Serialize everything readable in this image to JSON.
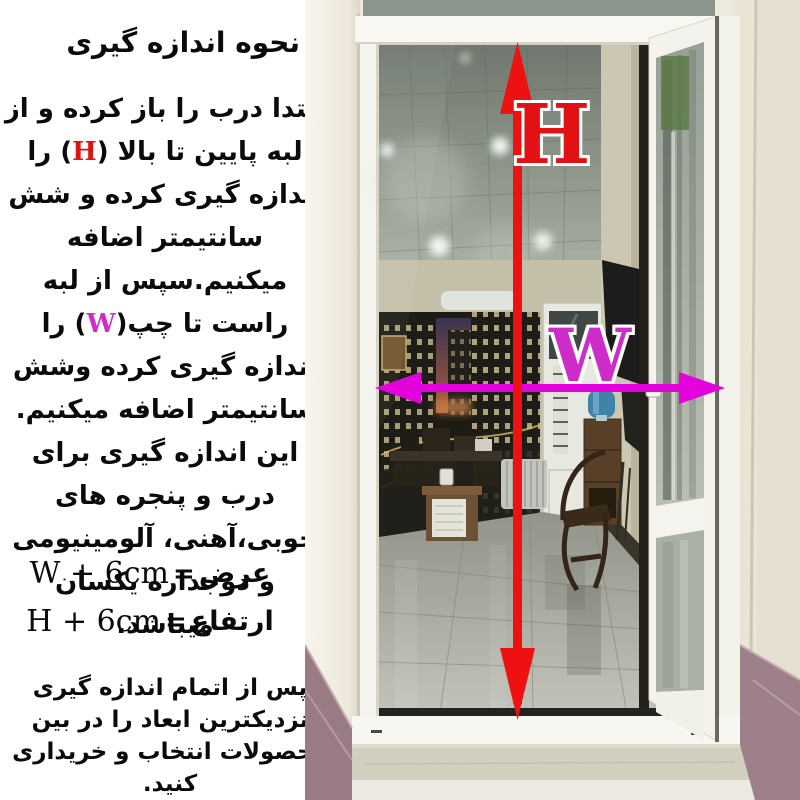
{
  "instructions": {
    "title": "نحوه اندازه گیری",
    "paragraph": {
      "part1": "ابتدا درب را باز کرده و از لبه پایین تا بالا (",
      "h_var": "H",
      "part2": ") را اندازه گیری کرده و شش سانتیمتر اضافه میکنیم.سپس از لبه راست تا چپ(",
      "w_var": "W",
      "part3": ") را اندازه گیری کرده وشش سانتیمتر اضافه میکنیم. این اندازه گیری برای درب و پنجره های چوبی،آهنی، آلومینیومی و دوجداره یکسان میباشد."
    },
    "width_formula": {
      "label": "عرض",
      "equals": "=",
      "value": "W + 6cm"
    },
    "height_formula": {
      "label": "ارتفاع",
      "equals": "=",
      "value": "H + 6cm"
    },
    "footer_note": "پس از اتمام اندازه گیری نزدیکترین ابعاد را در بین محصولات انتخاب و خریداری کنید."
  },
  "diagram": {
    "height_label": "H",
    "width_label": "W",
    "arrow_red": "#ee1112",
    "arrow_magenta": "#e402dc",
    "height_label_color": "#e21113",
    "width_label_color": "#ce2cc9"
  }
}
